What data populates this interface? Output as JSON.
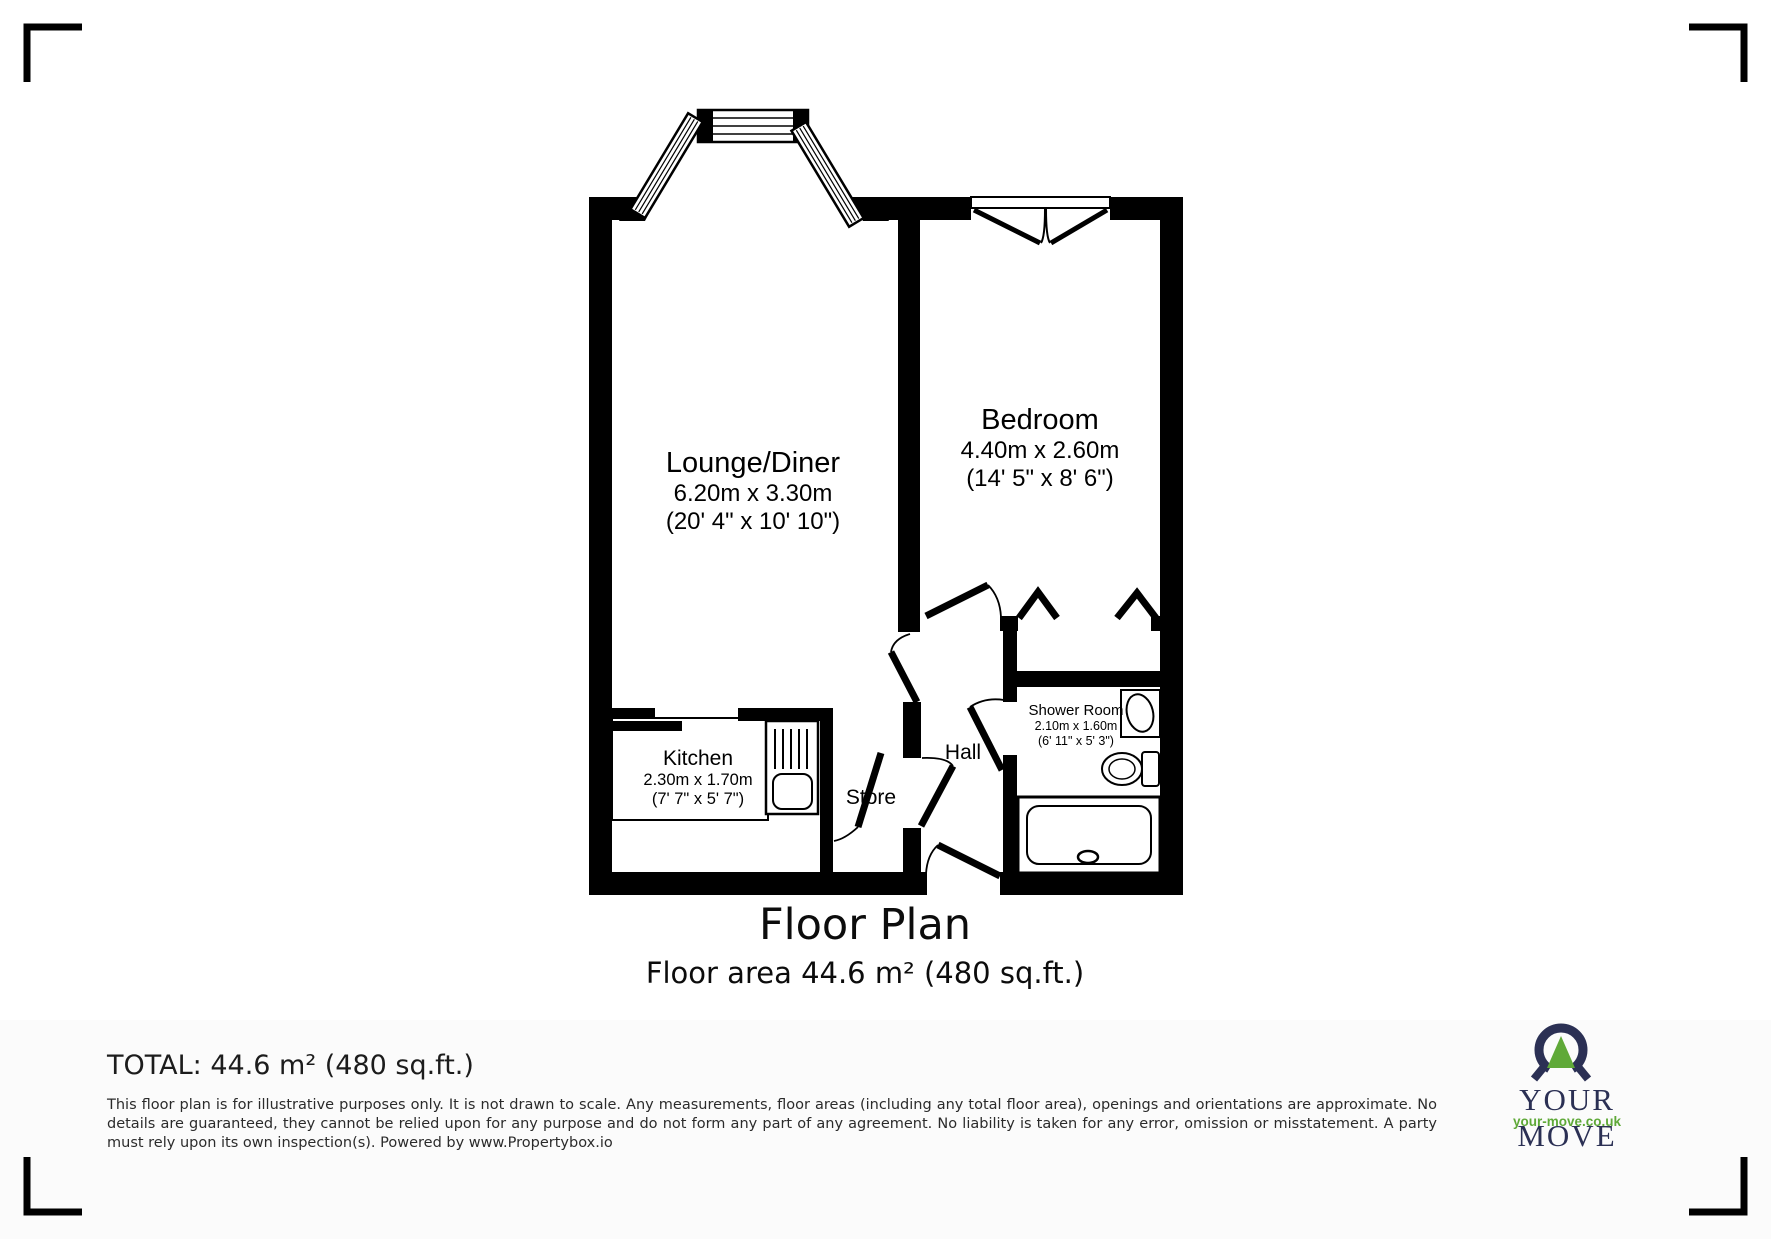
{
  "plan": {
    "title": "Floor Plan",
    "subtitle": "Floor area 44.6 m² (480 sq.ft.)",
    "rooms": {
      "lounge": {
        "name": "Lounge/Diner",
        "metric": "6.20m x 3.30m",
        "imperial": "(20' 4\" x 10' 10\")"
      },
      "bedroom": {
        "name": "Bedroom",
        "metric": "4.40m x 2.60m",
        "imperial": "(14' 5\" x 8' 6\")"
      },
      "kitchen": {
        "name": "Kitchen",
        "metric": "2.30m x 1.70m",
        "imperial": "(7' 7\" x 5' 7\")"
      },
      "shower": {
        "name": "Shower Room",
        "metric": "2.10m x 1.60m",
        "imperial": "(6' 11\" x 5' 3\")"
      },
      "store": {
        "name": "Store"
      },
      "hall": {
        "name": "Hall"
      }
    }
  },
  "footer": {
    "total": "TOTAL: 44.6 m² (480 sq.ft.)",
    "disclaimer": "This floor plan is for illustrative purposes only. It is not drawn to scale. Any measurements, floor areas (including any total floor area), openings and orientations are approximate. No details are guaranteed, they cannot be relied upon for any purpose and do not form any part of any agreement. No liability is taken for any error, omission or misstatement. A party must rely upon its own inspection(s). Powered by www.Propertybox.io"
  },
  "logo": {
    "brand": "YOUR MOVE",
    "website": "your-move.co.uk",
    "navy": "#2b3054",
    "green": "#5fa938"
  }
}
